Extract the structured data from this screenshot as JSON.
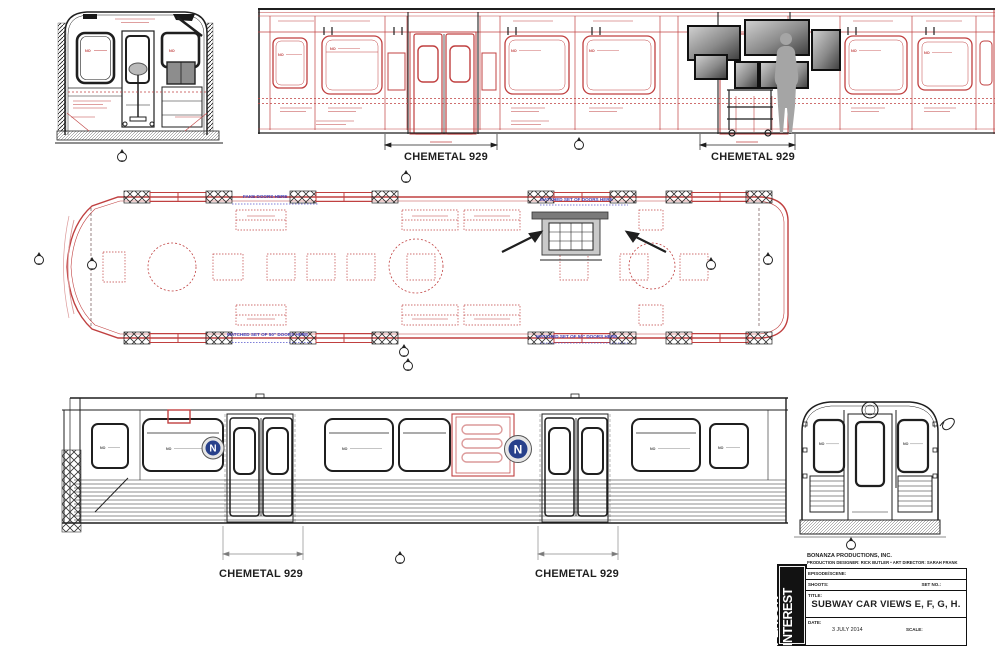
{
  "colors": {
    "line_red": "#c04040",
    "line_pink": "#dc9a9a",
    "line_black": "#1f1f1f",
    "note_blue": "#4444bb",
    "badge_blue": "#27408b",
    "silhouette_gray": "#a5a5a5"
  },
  "chemetal_labels": [
    "CHEMETAL 929",
    "CHEMETAL 929",
    "CHEMETAL 929",
    "CHEMETAL 929"
  ],
  "blue_notes": {
    "fake_doors": "FAKE DOORS HERE",
    "matched_doors": "MATCHED SET OF DOORS HERE",
    "matched_50_left": "MATCHED SET OF 50\" DOORS HERE",
    "matched_50_center": "MATCHED SET OF 50\" DOORS HERE"
  },
  "stencils": {
    "no": "NO",
    "badge_letter": "N"
  },
  "title_block": {
    "company": "BONANZA PRODUCTIONS, INC.",
    "credits": "PRODUCTION DESIGNER: RICK BUTLER • ART DIRECTOR: SARAH FRANK",
    "episode_label": "EPISODE/SCENE:",
    "shoot_label": "SHOOTS:",
    "set_no_label": "SET NO.:",
    "title_label": "TITLE:",
    "drawing_title": "SUBWAY CAR VIEWS E, F, G, H.",
    "date_label": "DATE:",
    "date_value": "3 JULY 2014",
    "scale_label": "SCALE:",
    "logo_word1": "PERSON",
    "logo_word2": "OF",
    "logo_word3": "INTEREST"
  }
}
